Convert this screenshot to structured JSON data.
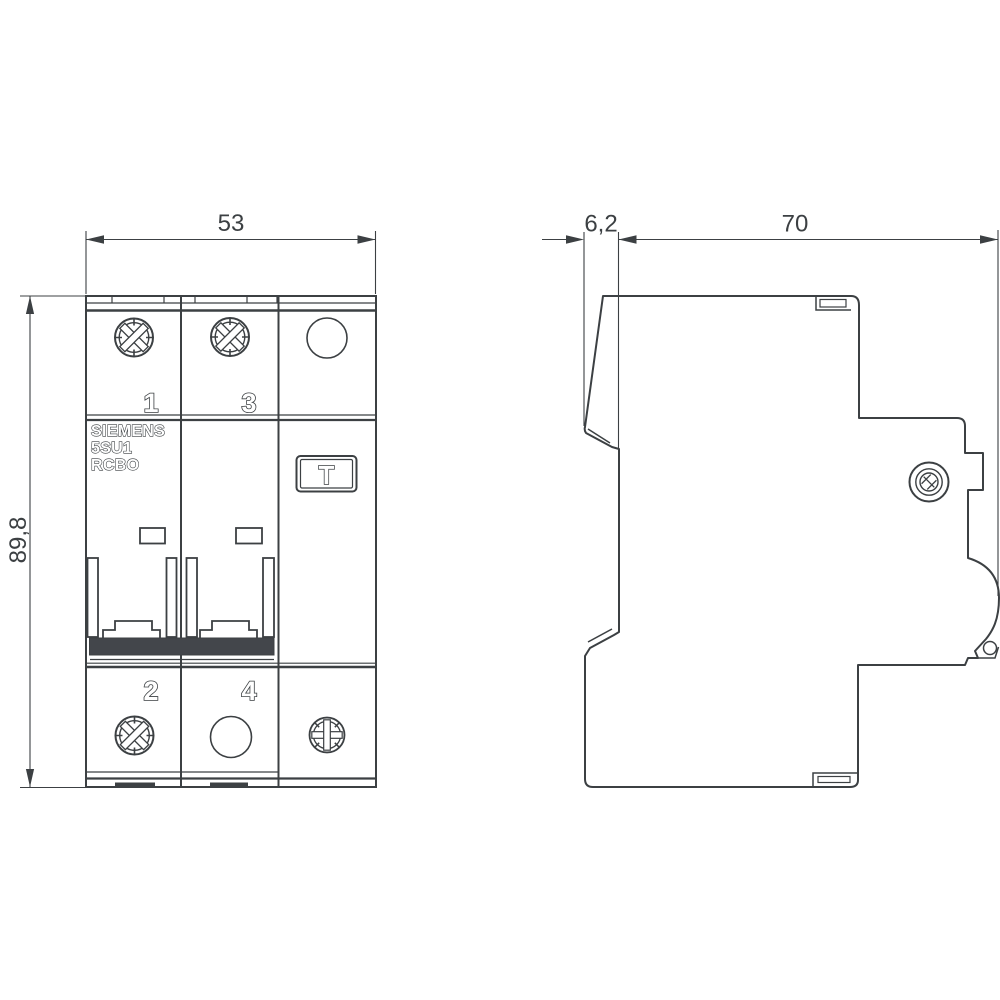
{
  "title": "Siemens 5SU1 RCBO dimensional drawing (front and side view)",
  "colors": {
    "line": "#3c4043",
    "toggle_fill": "#43464b",
    "background": "#ffffff"
  },
  "front_view": {
    "dim_width": "53",
    "dim_height": "89,8",
    "terminals_top": [
      "1",
      "3"
    ],
    "terminals_bottom": [
      "2",
      "4"
    ],
    "brand_lines": [
      "SIEMENS",
      "5SU1",
      "RCBO"
    ],
    "test_button_label": "T"
  },
  "side_view": {
    "dim_front_depth": "6,2",
    "dim_total_depth": "70"
  }
}
